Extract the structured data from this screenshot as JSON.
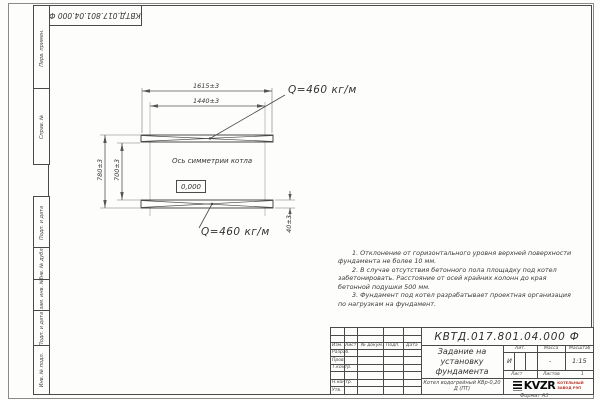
{
  "page": {
    "format_label": "Формат А3"
  },
  "stamp_top": {
    "doc_number": "КВТД.017.801.04.000 Ф"
  },
  "side_columns": {
    "perv_primen": "Перв. примен.",
    "sprav_no": "Справ. №",
    "podp_data_1": "Подп. и дата",
    "inv_dubl": "Инв. № дубл.",
    "vzam_inv": "Взам. инв. №",
    "podp_data_2": "Подп. и дата",
    "inv_podl": "Инв. № подл."
  },
  "drawing": {
    "dim_width_outer": "1615±3",
    "dim_width_inner": "1440±3",
    "dim_height_outer": "780±3",
    "dim_height_inner": "700±3",
    "dim_pad_thickness": "40±3",
    "load_top": "Q=460 кг/м",
    "load_bottom": "Q=460 кг/м",
    "axis_label": "Ось симметрии котла",
    "elevation": "0,000"
  },
  "notes": [
    "1. Отклонение от горизонтального уровня верхней поверхности фундамента не более 10 мм.",
    "2. В случае отсутствия бетонного пола площадку под котел забетонировать. Расстояние от осей крайних колонн до края бетонной подушки 500 мм.",
    "3. Фундамент под котел разрабатывает проектная организация по нагрузкам на фундамент."
  ],
  "title_block": {
    "doc_number": "КВТД.017.801.04.000 Ф",
    "title": "Задание на установку фундамента",
    "product": "Котел водогрейный КВр-0,20 Д (ПТ)",
    "col_headers": [
      "Изм.",
      "Лист",
      "№ докум.",
      "Подп.",
      "Дата"
    ],
    "sign_rows": [
      "Разраб.",
      "Пров.",
      "Т.контр.",
      "",
      "Н.контр.",
      "Утв."
    ],
    "lit_label": "Лит.",
    "lit_value": "И",
    "mass_label": "Масса",
    "mass_value": "-",
    "scale_label": "Масштаб",
    "scale_value": "1:15",
    "sheet_label": "Лист",
    "sheets_label": "Листов",
    "sheets_value": "1",
    "logo_text": "KVZR",
    "logo_caption": "КОТЕЛЬНЫЙ ЗАВОД РЭП"
  },
  "colors": {
    "line": "#4a4a4a",
    "logo_caption": "#c0392b"
  }
}
